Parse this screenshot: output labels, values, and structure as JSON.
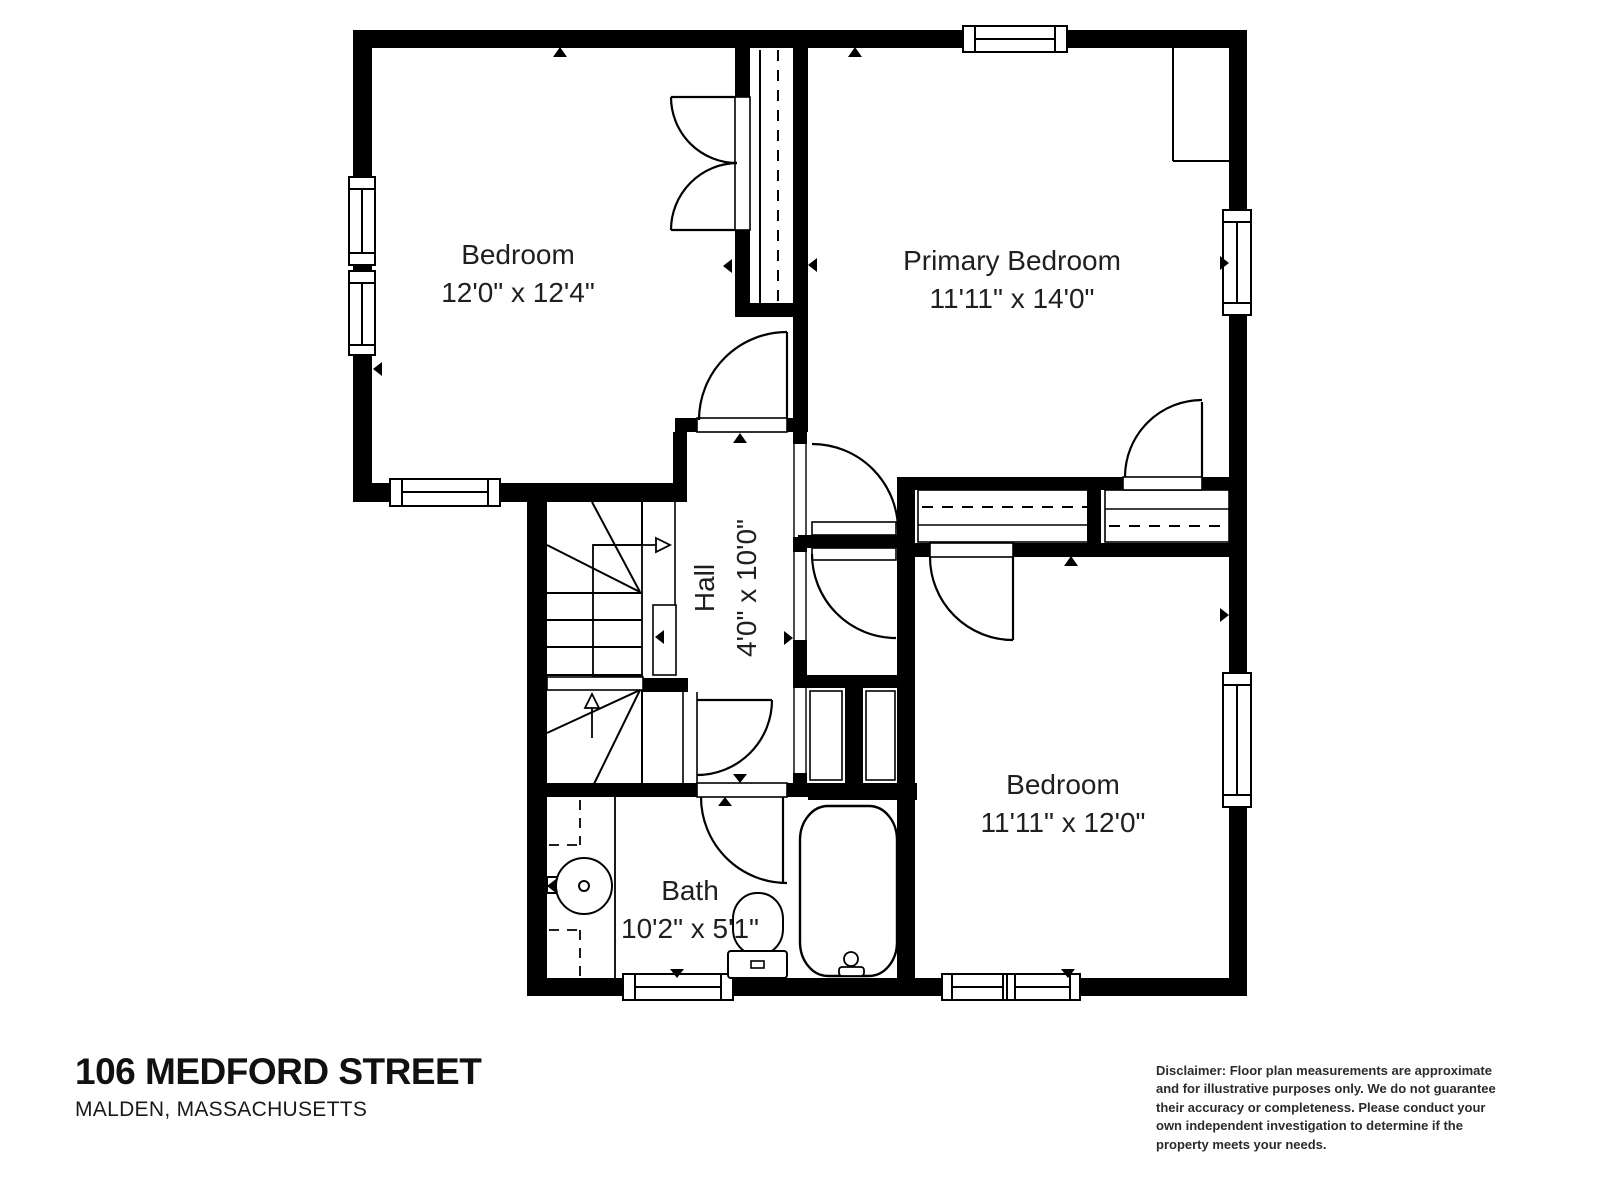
{
  "floor_plan": {
    "rooms": [
      {
        "id": "bedroom-top-left",
        "label": "Bedroom",
        "dimensions": "12'0\" x 12'4\""
      },
      {
        "id": "primary-bedroom",
        "label": "Primary Bedroom",
        "dimensions": "11'11\" x 14'0\""
      },
      {
        "id": "hall",
        "label": "Hall",
        "dimensions": "4'0\" x 10'0\""
      },
      {
        "id": "bedroom-bottom-right",
        "label": "Bedroom",
        "dimensions": "11'11\" x 12'0\""
      },
      {
        "id": "bath",
        "label": "Bath",
        "dimensions": "10'2\" x 5'1\""
      }
    ],
    "features": [
      "stairs",
      "closets",
      "bathtub",
      "toilet",
      "sink-vanity",
      "windows",
      "door-swings"
    ]
  },
  "footer": {
    "address": "106 MEDFORD STREET",
    "city_state": "MALDEN, MASSACHUSETTS",
    "disclaimer": "Disclaimer: Floor plan measurements are approximate and for illustrative purposes only. We do not guarantee their accuracy or completeness. Please conduct your own independent investigation to determine if the property meets your needs."
  },
  "colors": {
    "wall": "#000000",
    "background": "#ffffff",
    "label_text": "#1f1f1f"
  }
}
